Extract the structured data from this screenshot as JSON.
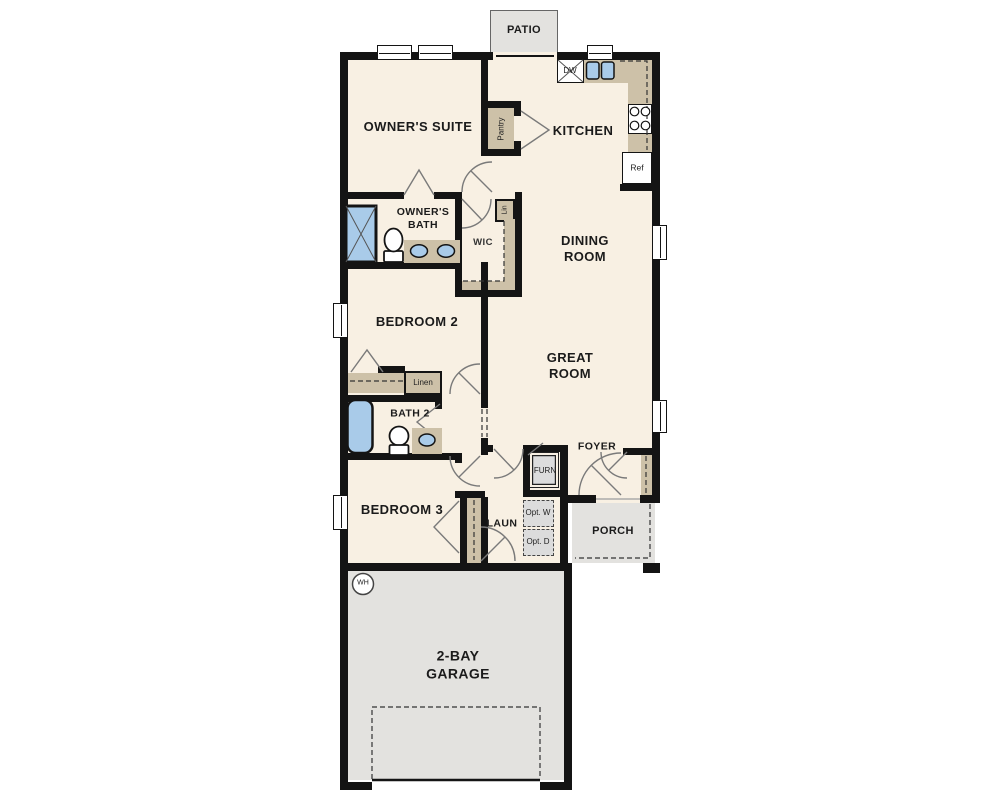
{
  "labels": {
    "patio": "PATIO",
    "owners_suite": "OWNER'S SUITE",
    "kitchen": "KITCHEN",
    "pantry": "Pantry",
    "dishwasher": "DW",
    "refrigerator": "Ref",
    "owners_bath": "OWNER'S BATH",
    "linen_1": "Lin",
    "wic": "WIC",
    "dining_room": "DINING ROOM",
    "bedroom_2": "BEDROOM 2",
    "linen_2": "Linen",
    "bath_2": "BATH 2",
    "great_room": "GREAT ROOM",
    "foyer": "FOYER",
    "furnace": "FURN",
    "laundry": "LAUN",
    "opt_washer": "Opt. W",
    "opt_dryer": "Opt. D",
    "bedroom_3": "BEDROOM 3",
    "porch": "PORCH",
    "water_heater": "WH",
    "garage": "2-BAY GARAGE"
  },
  "colors": {
    "wall": "#141414",
    "floor": "#f8f0e3",
    "outdoor": "#e3e2df",
    "counter": "#cdc1a8",
    "fixture_blue": "#a9cbe9",
    "appliance_gray": "#dcdcdc"
  }
}
